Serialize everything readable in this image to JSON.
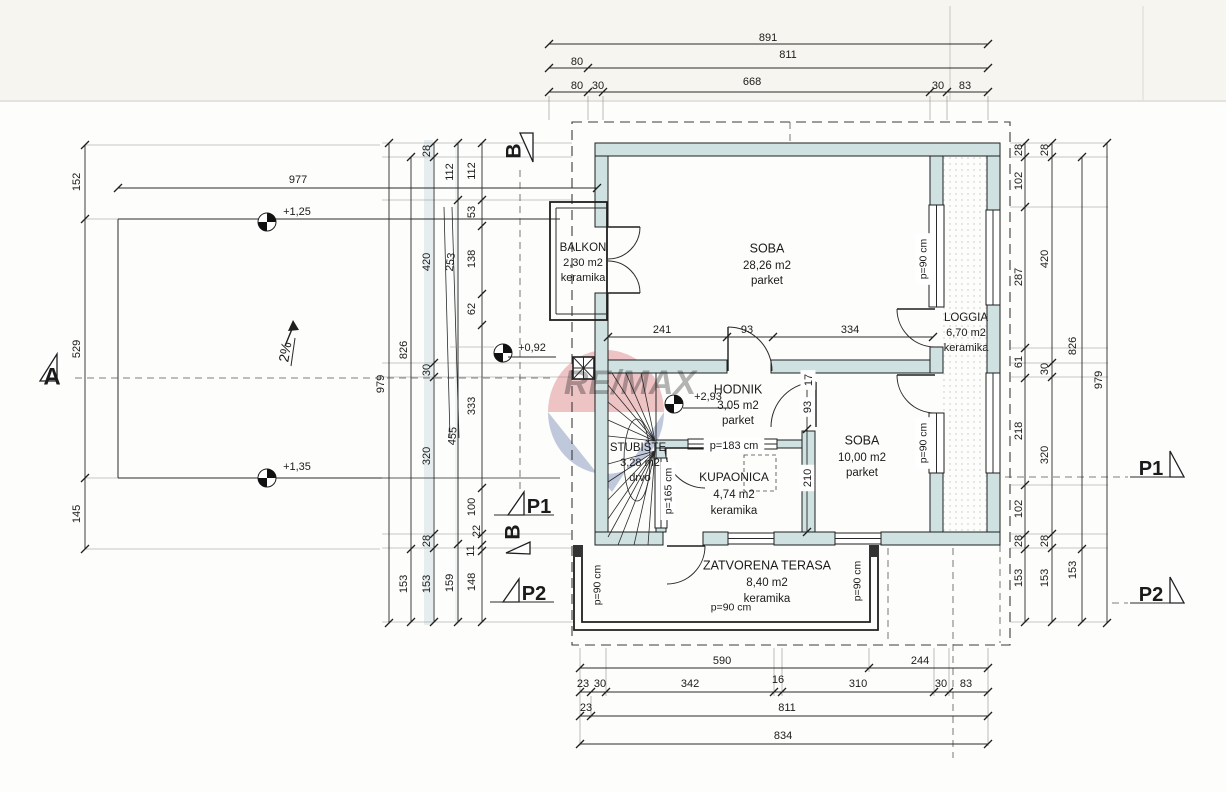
{
  "document": {
    "type": "architectural-floor-plan",
    "scan_watermark": "RE/MAX"
  },
  "colors": {
    "wall_fill": "#cfe1e1",
    "paper": "#fdfdfb",
    "line": "#1f1f1f",
    "watermark_red": "#c5303a",
    "watermark_blue": "#27418f"
  },
  "annotations": {
    "top_dims": [
      {
        "t": "891",
        "x": 768,
        "y": 37,
        "n": "dim-top-891"
      },
      {
        "t": "80",
        "x": 577,
        "y": 61
      },
      {
        "t": "811",
        "x": 788,
        "y": 54
      },
      {
        "t": "80",
        "x": 577,
        "y": 85
      },
      {
        "t": "30",
        "x": 598,
        "y": 85
      },
      {
        "t": "668",
        "x": 752,
        "y": 81
      },
      {
        "t": "30",
        "x": 938,
        "y": 85
      },
      {
        "t": "83",
        "x": 965,
        "y": 85
      }
    ],
    "bottom_dims": [
      {
        "t": "590",
        "x": 722,
        "y": 660
      },
      {
        "t": "244",
        "x": 920,
        "y": 660
      },
      {
        "t": "23",
        "x": 583,
        "y": 683
      },
      {
        "t": "30",
        "x": 600,
        "y": 683
      },
      {
        "t": "342",
        "x": 690,
        "y": 683
      },
      {
        "t": "16",
        "x": 778,
        "y": 679
      },
      {
        "t": "310",
        "x": 858,
        "y": 683
      },
      {
        "t": "30",
        "x": 941,
        "y": 683
      },
      {
        "t": "83",
        "x": 966,
        "y": 683
      },
      {
        "t": "23",
        "x": 586,
        "y": 707
      },
      {
        "t": "811",
        "x": 787,
        "y": 707
      },
      {
        "t": "834",
        "x": 783,
        "y": 735
      }
    ],
    "left_dims": [
      {
        "t": "152",
        "x": 76,
        "y": 182,
        "r": -90
      },
      {
        "t": "529",
        "x": 76,
        "y": 349,
        "r": -90
      },
      {
        "t": "145",
        "x": 76,
        "y": 514,
        "r": -90
      },
      {
        "t": "979",
        "x": 380,
        "y": 384,
        "r": -90
      },
      {
        "t": "826",
        "x": 403,
        "y": 350,
        "r": -90
      },
      {
        "t": "153",
        "x": 403,
        "y": 584,
        "r": -90
      },
      {
        "t": "28",
        "x": 426,
        "y": 151,
        "r": -90
      },
      {
        "t": "420",
        "x": 426,
        "y": 262,
        "r": -90
      },
      {
        "t": "30",
        "x": 426,
        "y": 370,
        "r": -90
      },
      {
        "t": "320",
        "x": 426,
        "y": 456,
        "r": -90
      },
      {
        "t": "28",
        "x": 426,
        "y": 541,
        "r": -90
      },
      {
        "t": "153",
        "x": 426,
        "y": 584,
        "r": -90
      },
      {
        "t": "112",
        "x": 449,
        "y": 172,
        "r": -90
      },
      {
        "t": "253",
        "x": 450,
        "y": 262,
        "r": -83
      },
      {
        "t": "455",
        "x": 452,
        "y": 436,
        "r": -86
      },
      {
        "t": "159",
        "x": 449,
        "y": 583,
        "r": -90
      },
      {
        "t": "112",
        "x": 471,
        "y": 171,
        "r": -90
      },
      {
        "t": "53",
        "x": 471,
        "y": 212,
        "r": -90
      },
      {
        "t": "138",
        "x": 471,
        "y": 259,
        "r": -90
      },
      {
        "t": "62",
        "x": 471,
        "y": 309,
        "r": -90
      },
      {
        "t": "333",
        "x": 471,
        "y": 406,
        "r": -90
      },
      {
        "t": "100",
        "x": 471,
        "y": 507,
        "r": -90
      },
      {
        "t": "22",
        "x": 476,
        "y": 531,
        "r": -90
      },
      {
        "t": "11",
        "x": 470,
        "y": 551,
        "r": -90
      },
      {
        "t": "148",
        "x": 471,
        "y": 582,
        "r": -90
      }
    ],
    "right_dims": [
      {
        "t": "28",
        "x": 1018,
        "y": 150,
        "r": -90
      },
      {
        "t": "102",
        "x": 1018,
        "y": 181,
        "r": -90
      },
      {
        "t": "287",
        "x": 1018,
        "y": 277,
        "r": -90
      },
      {
        "t": "61",
        "x": 1018,
        "y": 362,
        "r": -90
      },
      {
        "t": "218",
        "x": 1018,
        "y": 431,
        "r": -90
      },
      {
        "t": "102",
        "x": 1018,
        "y": 509,
        "r": -90
      },
      {
        "t": "28",
        "x": 1018,
        "y": 541,
        "r": -90
      },
      {
        "t": "153",
        "x": 1018,
        "y": 578,
        "r": -90
      },
      {
        "t": "28",
        "x": 1044,
        "y": 150,
        "r": -90
      },
      {
        "t": "420",
        "x": 1044,
        "y": 259,
        "r": -90
      },
      {
        "t": "30",
        "x": 1044,
        "y": 369,
        "r": -90
      },
      {
        "t": "320",
        "x": 1044,
        "y": 455,
        "r": -90
      },
      {
        "t": "28",
        "x": 1044,
        "y": 541,
        "r": -90
      },
      {
        "t": "153",
        "x": 1044,
        "y": 578,
        "r": -90
      },
      {
        "t": "826",
        "x": 1072,
        "y": 346,
        "r": -90
      },
      {
        "t": "153",
        "x": 1072,
        "y": 570,
        "r": -90
      },
      {
        "t": "979",
        "x": 1098,
        "y": 380,
        "r": -90
      }
    ],
    "inner_dims": [
      {
        "t": "241",
        "x": 662,
        "y": 329
      },
      {
        "t": "93",
        "x": 747,
        "y": 329
      },
      {
        "t": "334",
        "x": 850,
        "y": 329
      },
      {
        "t": "17",
        "x": 808,
        "y": 380,
        "r": -90,
        "bg": 1
      },
      {
        "t": "93",
        "x": 807,
        "y": 407,
        "r": -90,
        "bg": 1
      },
      {
        "t": "210",
        "x": 807,
        "y": 478,
        "r": -90,
        "bg": 1
      },
      {
        "t": "977",
        "x": 298,
        "y": 179
      }
    ],
    "parapet_labels": [
      {
        "t": "p=90 cm",
        "x": 923,
        "y": 259,
        "r": -90,
        "s": 10.5,
        "bg": 1,
        "n": "parapet-loggia-window-1"
      },
      {
        "t": "p=90 cm",
        "x": 923,
        "y": 443,
        "r": -90,
        "s": 10.5,
        "bg": 1,
        "n": "parapet-loggia-window-2"
      },
      {
        "t": "p=183 cm",
        "x": 734,
        "y": 445,
        "s": 11,
        "bg": 1,
        "n": "parapet-hodnik-window"
      },
      {
        "t": "p=165 cm",
        "x": 668,
        "y": 491,
        "r": -90,
        "s": 10.5,
        "bg": 1,
        "n": "parapet-stubiste-window"
      },
      {
        "t": "p=90 cm",
        "x": 597,
        "y": 585,
        "r": -90,
        "s": 10.5,
        "n": "parapet-terasa-left"
      },
      {
        "t": "p=90 cm",
        "x": 857,
        "y": 581,
        "r": -90,
        "s": 10.5,
        "n": "parapet-terasa-right"
      },
      {
        "t": "p=90 cm",
        "x": 731,
        "y": 607,
        "s": 10.5,
        "n": "parapet-terasa-bottom"
      }
    ],
    "room_labels": [
      {
        "t": "BALKON",
        "x": 583,
        "y": 247,
        "s": 11.5,
        "n": "room-label-balkon"
      },
      {
        "t": "2,30 m2",
        "x": 583,
        "y": 262,
        "s": 11
      },
      {
        "t": "keramika",
        "x": 583,
        "y": 277,
        "s": 11
      },
      {
        "t": "SOBA",
        "x": 767,
        "y": 248,
        "s": 12.5,
        "n": "room-label-soba-1"
      },
      {
        "t": "28,26 m2",
        "x": 767,
        "y": 265,
        "s": 11.5
      },
      {
        "t": "parket",
        "x": 767,
        "y": 280,
        "s": 11.5
      },
      {
        "t": "LOGGIA",
        "x": 966,
        "y": 317,
        "s": 11.5,
        "n": "room-label-loggia"
      },
      {
        "t": "6,70 m2",
        "x": 966,
        "y": 332,
        "s": 11
      },
      {
        "t": "keramika",
        "x": 966,
        "y": 347,
        "s": 11
      },
      {
        "t": "HODNIK",
        "x": 738,
        "y": 389,
        "s": 12.5,
        "n": "room-label-hodnik"
      },
      {
        "t": "3,05 m2",
        "x": 738,
        "y": 405,
        "s": 11.5
      },
      {
        "t": "parket",
        "x": 738,
        "y": 420,
        "s": 11.5
      },
      {
        "t": "STUBIŠTE",
        "x": 638,
        "y": 447,
        "s": 11.5,
        "n": "room-label-stubiste"
      },
      {
        "t": "3,28 m2",
        "x": 640,
        "y": 462,
        "s": 11
      },
      {
        "t": "drvo",
        "x": 640,
        "y": 477,
        "s": 11
      },
      {
        "t": "KUPAONICA",
        "x": 734,
        "y": 477,
        "s": 12,
        "n": "room-label-kupaonica"
      },
      {
        "t": "4,74 m2",
        "x": 734,
        "y": 494,
        "s": 11.5
      },
      {
        "t": "keramika",
        "x": 734,
        "y": 510,
        "s": 11.5
      },
      {
        "t": "SOBA",
        "x": 862,
        "y": 440,
        "s": 12.5,
        "n": "room-label-soba-2"
      },
      {
        "t": "10,00 m2",
        "x": 862,
        "y": 457,
        "s": 11.5
      },
      {
        "t": "parket",
        "x": 862,
        "y": 472,
        "s": 11.5
      },
      {
        "t": "ZATVORENA TERASA",
        "x": 767,
        "y": 565,
        "s": 12.5,
        "n": "room-label-terasa"
      },
      {
        "t": "8,40 m2",
        "x": 767,
        "y": 582,
        "s": 11.5
      },
      {
        "t": "keramika",
        "x": 767,
        "y": 598,
        "s": 11.5
      }
    ],
    "level_markers": [
      {
        "t": "+1,25",
        "x": 297,
        "y": 211,
        "s": 11,
        "n": "level-plus-1-25"
      },
      {
        "t": "+1,35",
        "x": 297,
        "y": 466,
        "s": 11,
        "n": "level-plus-1-35"
      },
      {
        "t": "+0,92",
        "x": 532,
        "y": 347,
        "s": 11,
        "n": "level-plus-0-92"
      },
      {
        "t": "+2,93",
        "x": 708,
        "y": 396,
        "s": 11,
        "n": "level-plus-2-93"
      }
    ],
    "section_labels": [
      {
        "t": "A",
        "x": 52,
        "y": 376,
        "s": 24,
        "w": "bold",
        "n": "section-a"
      },
      {
        "t": "B",
        "x": 513,
        "y": 151,
        "r": -90,
        "s": 21,
        "w": "bold",
        "n": "section-b-top"
      },
      {
        "t": "B",
        "x": 512,
        "y": 532,
        "r": -90,
        "s": 21,
        "w": "bold",
        "n": "section-b-bottom"
      },
      {
        "t": "P1",
        "x": 539,
        "y": 506,
        "s": 20,
        "w": "bold",
        "n": "section-p1-left"
      },
      {
        "t": "P2",
        "x": 534,
        "y": 593,
        "s": 20,
        "w": "bold",
        "n": "section-p2-left"
      },
      {
        "t": "P1",
        "x": 1151,
        "y": 468,
        "s": 20,
        "w": "bold",
        "n": "section-p1-right"
      },
      {
        "t": "P2",
        "x": 1151,
        "y": 594,
        "s": 20,
        "w": "bold",
        "n": "section-p2-right"
      }
    ],
    "slope": [
      {
        "t": "2%",
        "x": 285,
        "y": 352,
        "r": -80,
        "s": 14,
        "n": "slope-label"
      }
    ],
    "watermark": [
      {
        "t": "RE/MAX",
        "x": 630,
        "y": 382,
        "s": 34,
        "w": "bold",
        "it": 1,
        "fill": "#c5303a",
        "op": 0.32,
        "n": "watermark-text"
      }
    ]
  }
}
